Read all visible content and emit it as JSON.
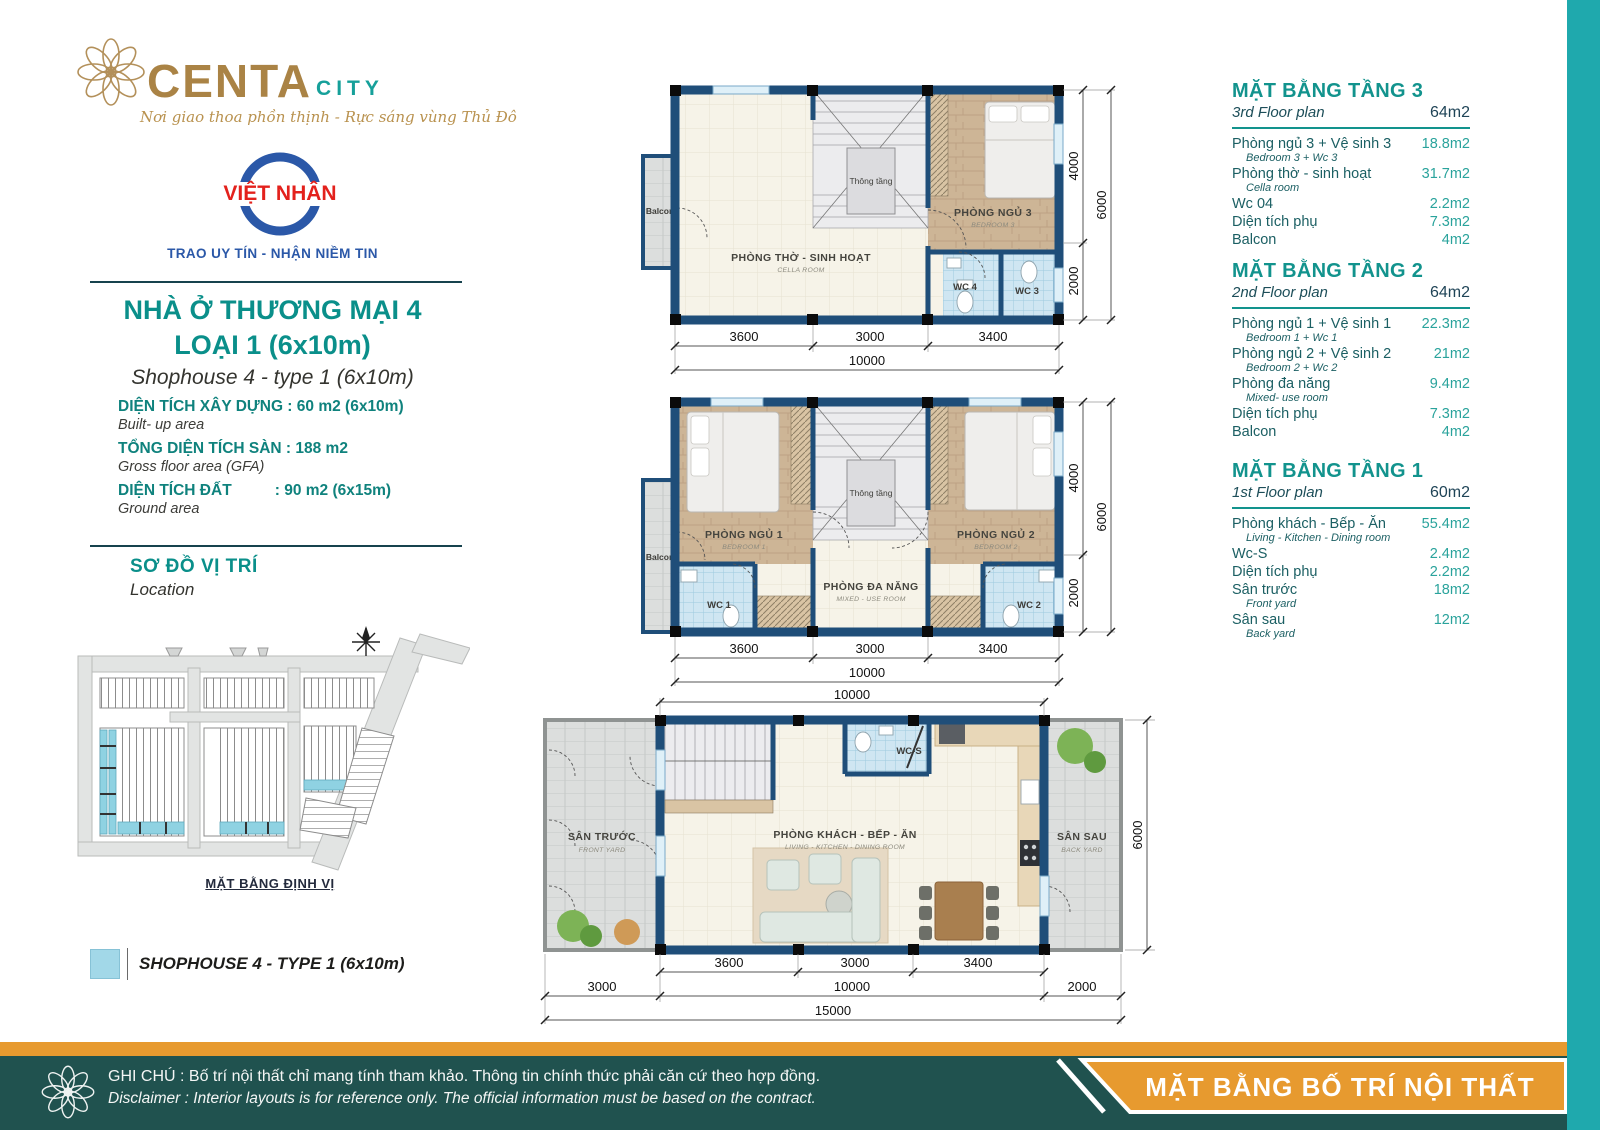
{
  "branding": {
    "logo_main": "CENTA",
    "logo_accent": "CITY",
    "tagline": "Nơi giao thoa phồn thịnh - Rực sáng vùng Thủ Đô",
    "partner_name": "VIỆT NHÂN",
    "partner_slogan": "TRAO UY TÍN - NHẬN NIỀM TIN"
  },
  "product": {
    "title_line1": "NHÀ Ở THƯƠNG MẠI 4",
    "title_line2": "LOẠI 1 (6x10m)",
    "subtitle": "Shophouse 4 - type 1 (6x10m)",
    "specs": [
      {
        "label": "DIỆN TÍCH XÂY DỰNG : 60 m2 (6x10m)",
        "sub": "Built- up area"
      },
      {
        "label": "TỔNG DIỆN TÍCH SÀN : 188 m2",
        "sub": "Gross floor area (GFA)"
      },
      {
        "label": "DIỆN TÍCH ĐẤT          : 90 m2 (6x15m)",
        "sub": "Ground area"
      }
    ]
  },
  "location": {
    "title": "SƠ ĐỒ VỊ TRÍ",
    "subtitle": "Location",
    "map_caption": "MẶT BẰNG ĐỊNH VỊ"
  },
  "legend": {
    "label": "SHOPHOUSE 4 - TYPE 1 (6x10m)",
    "swatch_color": "#a2d8e8"
  },
  "floor_tables": [
    {
      "title": "MẶT BẰNG TẦNG 3",
      "subtitle": "3rd Floor plan",
      "total": "64m2",
      "rows": [
        {
          "vi": "Phòng ngủ 3 + Vệ sinh 3",
          "en": "Bedroom 3 + Wc 3",
          "area": "18.8m2"
        },
        {
          "vi": "Phòng thờ - sinh hoạt",
          "en": "Cella room",
          "area": "31.7m2"
        },
        {
          "vi": "Wc 04",
          "en": "",
          "area": "2.2m2"
        },
        {
          "vi": "Diện tích phụ",
          "en": "",
          "area": "7.3m2"
        },
        {
          "vi": "Balcon",
          "en": "",
          "area": "4m2"
        }
      ]
    },
    {
      "title": "MẶT BẰNG TẦNG 2",
      "subtitle": "2nd Floor plan",
      "total": "64m2",
      "rows": [
        {
          "vi": "Phòng ngủ 1 + Vệ sinh 1",
          "en": "Bedroom 1 + Wc 1",
          "area": "22.3m2"
        },
        {
          "vi": "Phòng ngủ 2 + Vệ sinh 2",
          "en": "Bedroom 2 + Wc 2",
          "area": "21m2"
        },
        {
          "vi": "Phòng đa năng",
          "en": "Mixed- use room",
          "area": "9.4m2"
        },
        {
          "vi": "Diện tích phụ",
          "en": "",
          "area": "7.3m2"
        },
        {
          "vi": "Balcon",
          "en": "",
          "area": "4m2"
        }
      ]
    },
    {
      "title": "MẶT BẰNG TẦNG 1",
      "subtitle": "1st Floor plan",
      "total": "60m2",
      "rows": [
        {
          "vi": "Phòng khách - Bếp - Ăn",
          "en": "Living - Kitchen - Dining room",
          "area": "55.4m2"
        },
        {
          "vi": "Wc-S",
          "en": "",
          "area": "2.4m2"
        },
        {
          "vi": "Diện tích phụ",
          "en": "",
          "area": "2.2m2"
        },
        {
          "vi": "Sân trước",
          "en": "Front yard",
          "area": "18m2"
        },
        {
          "vi": "Sân sau",
          "en": "Back yard",
          "area": "12m2"
        }
      ]
    }
  ],
  "plans": {
    "floor3": {
      "balcony": "Balcon",
      "cella_vi": "PHÒNG THỜ - SINH HOẠT",
      "cella_en": "CELLA ROOM",
      "void": "Thông tầng",
      "bed3_vi": "PHÒNG NGỦ 3",
      "bed3_en": "BEDROOM 3",
      "wc4": "WC 4",
      "wc3": "WC 3",
      "dim_a": "3600",
      "dim_b": "3000",
      "dim_c": "3400",
      "dim_w": "10000",
      "dim_d": "4000",
      "dim_e": "2000",
      "dim_h": "6000"
    },
    "floor2": {
      "balcony": "Balcon",
      "bed1_vi": "PHÒNG NGỦ 1",
      "bed1_en": "BEDROOM 1",
      "bed2_vi": "PHÒNG NGỦ 2",
      "bed2_en": "BEDROOM 2",
      "void": "Thông tầng",
      "multi_vi": "PHÒNG ĐA NĂNG",
      "multi_en": "MIXED - USE ROOM",
      "wc1": "WC 1",
      "wc2": "WC 2",
      "dim_a": "3600",
      "dim_b": "3000",
      "dim_c": "3400",
      "dim_w": "10000",
      "dim_d": "4000",
      "dim_e": "2000",
      "dim_h": "6000"
    },
    "floor1": {
      "living_vi": "PHÒNG KHÁCH - BẾP - ĂN",
      "living_en": "LIVING - KITCHEN - DINING ROOM",
      "wcs": "WC-S",
      "front_vi": "SÂN TRƯỚC",
      "front_en": "FRONT YARD",
      "back_vi": "SÂN SAU",
      "back_en": "BACK YARD",
      "dim_top": "10000",
      "dim_a": "3600",
      "dim_b": "3000",
      "dim_c": "3400",
      "dim_l": "3000",
      "dim_m": "10000",
      "dim_r": "2000",
      "dim_total": "15000",
      "dim_h": "6000"
    }
  },
  "footer": {
    "note_vi": "GHI CHÚ : Bố trí nội thất chỉ mang tính tham khảo. Thông tin chính thức phải căn cứ theo hợp đồng.",
    "note_en": "Disclaimer : Interior layouts is for reference only. The official information must be based on the contract.",
    "ribbon": "MẶT BẰNG BỐ TRÍ NỘI THẤT"
  },
  "colors": {
    "brand_gold": "#aa8345",
    "brand_teal": "#12938d",
    "wall_navy": "#1f4e79",
    "accent_orange": "#e79a2f",
    "footer_teal": "#20524f",
    "edge_strip_teal": "#1fa9ad",
    "highlight_blue": "#a2d8e8"
  }
}
